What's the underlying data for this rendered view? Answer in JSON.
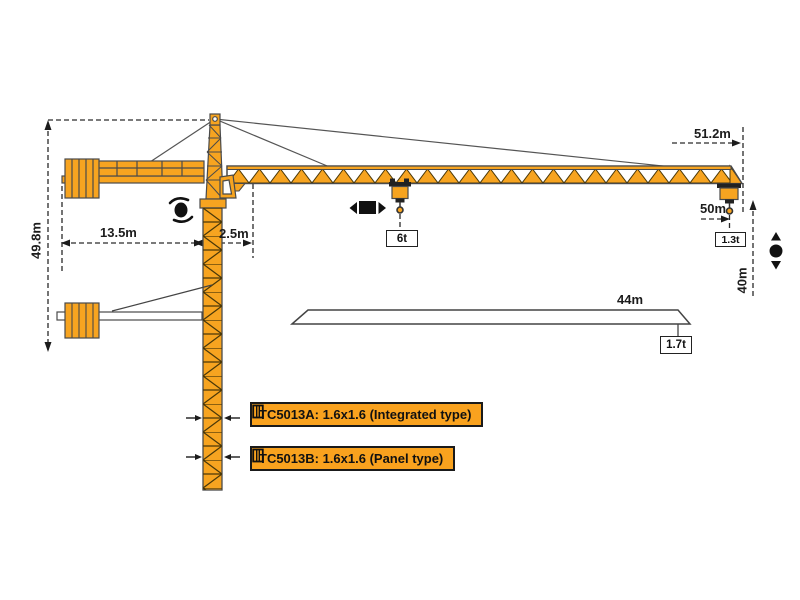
{
  "dimensions": {
    "total_height": "49.8m",
    "counter_jib_length": "13.5m",
    "jib_root_offset": "2.5m",
    "overall_radius": "51.2m",
    "working_radius": "50m",
    "hook_travel": "40m",
    "mid_jib_length": "44m"
  },
  "loads": {
    "max_load": "6t",
    "tip_load": "1.3t",
    "mid_tip_load": "1.7t"
  },
  "models": {
    "integrated": "TC5013A: 1.6x1.6 (Integrated type)",
    "panel": "TC5013B: 1.6x1.6 (Panel type)"
  },
  "icons": {
    "slewing": "slew-rotation-icon",
    "trolley_travel": "trolley-travel-icon",
    "hoisting": "hoist-up-down-icon",
    "mast_section": "mast-section-icon"
  },
  "colors": {
    "crane_orange": "#F7A420",
    "label_orange": "#F9A21E",
    "outline": "#4a4a4a",
    "dimension_line": "#2a2a2a"
  }
}
